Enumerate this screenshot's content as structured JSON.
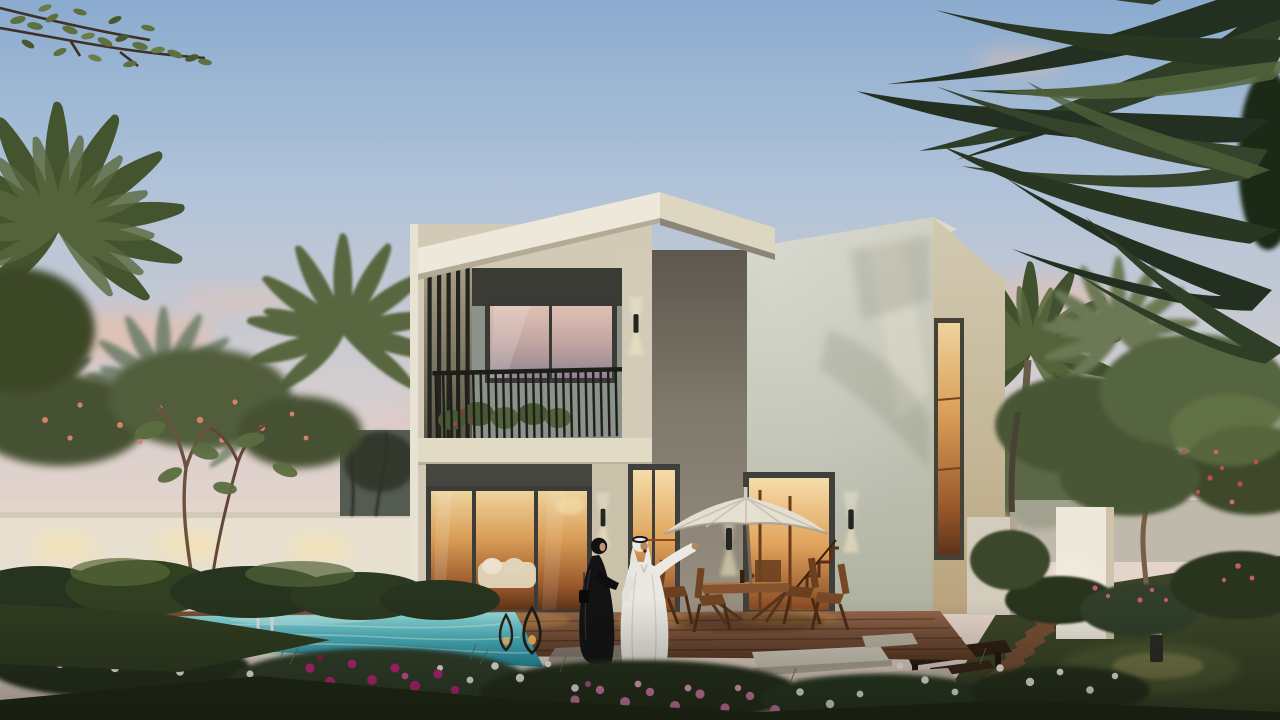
{
  "scene": {
    "setting": "Modern two-storey villa exterior at dusk with swimming pool, patio dining set, parasol and landscaped garden",
    "time_of_day": "dusk",
    "people": [
      {
        "id": "man-in-kandura",
        "description": "man in white kandura and ghutra, right arm raised pointing"
      },
      {
        "id": "woman-in-abaya",
        "description": "woman in black abaya and hijab facing the man"
      }
    ],
    "elements": [
      "dusk-sky",
      "sunset-clouds",
      "palm-trees",
      "overhanging-branch",
      "boundary-wall",
      "villa-left-volume",
      "louver-screen",
      "balcony",
      "balcony-railing",
      "sliding-glass-doors",
      "warm-interior",
      "roof-fascia",
      "villa-right-volume",
      "stair-door",
      "tall-window",
      "wall-sconces",
      "wood-deck",
      "swimming-pool",
      "pool-ladder",
      "lanterns",
      "patio-umbrella",
      "dining-set",
      "stepping-stones",
      "gate-pillars",
      "timber-walkway",
      "garden-bench",
      "bollard-light",
      "flower-beds",
      "front-lawn"
    ],
    "palette": {
      "sky_top": "#8fb0d4",
      "sky_mid": "#b6c9de",
      "sky_low": "#d9d2d3",
      "sky_horizon": "#ecdacf",
      "cloud_pink": "#f0c3ac",
      "facade_light": "#e9e2cf",
      "facade_beige": "#d8d0ba",
      "facade_shadow": "#8d887a",
      "fascia_white": "#f4efdf",
      "wall_right": "#cfd1c2",
      "wall_side": "#d8d0b6",
      "header_dark": "#3b3c35",
      "frame_dark": "#41423c",
      "glass_sunset": "#e2c2b2",
      "interior_amber": "#d98f42",
      "interior_deep": "#6e3c1d",
      "pool_light": "#8fd8da",
      "pool_deep": "#2d9fb2",
      "deck_wood": "#8a5f3e",
      "deck_dark": "#5e3b26",
      "lawn": "#39442a",
      "lawn_dark": "#212b17",
      "foliage_dark": "#2e3d24",
      "foliage": "#4a5a33",
      "foliage_light": "#6d7d48",
      "palm_hazy": "#8c9780",
      "flower_magenta": "#c0257a",
      "flower_rose": "#d981ad",
      "flower_white": "#f3f3e9",
      "flower_coral": "#d8876b",
      "boundary_wall_white": "#eee7d6",
      "pillar_white": "#f5efe2",
      "railing_dark": "#1d1e19",
      "trunk_brown": "#7a6047",
      "kandura_white": "#f0eee7",
      "abaya_black": "#131313",
      "skin_tan": "#bb8a5e",
      "umbrella_cream": "#ece6d7",
      "furniture_wood": "#8a5530",
      "lantern_amber": "#f5c26b",
      "sconce_glow": "#ffe9b0",
      "steel": "#dfe5e8"
    }
  }
}
